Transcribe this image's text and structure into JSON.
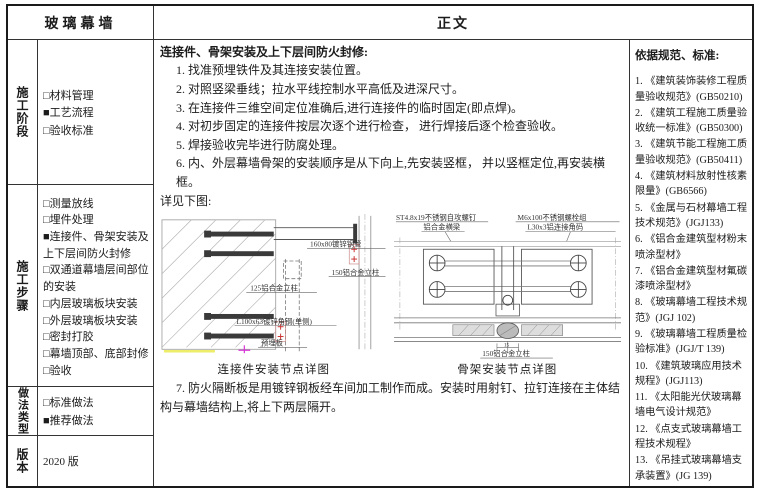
{
  "header": {
    "left_title": "玻璃幕墙",
    "right_title": "正文"
  },
  "sidebar": {
    "sections": [
      {
        "label": "施工阶段",
        "items": [
          {
            "box": "□",
            "text": "材料管理"
          },
          {
            "box": "■",
            "text": "工艺流程"
          },
          {
            "box": "□",
            "text": "验收标准"
          }
        ]
      },
      {
        "label": "施工步骤",
        "items": [
          {
            "box": "□",
            "text": "测量放线"
          },
          {
            "box": "□",
            "text": "埋件处理"
          },
          {
            "box": "■",
            "text": "连接件、骨架安装及上下层间防火封修"
          },
          {
            "box": "□",
            "text": "双通道幕墙层间部位的安装"
          },
          {
            "box": "□",
            "text": "内层玻璃板块安装"
          },
          {
            "box": "□",
            "text": "外层玻璃板块安装"
          },
          {
            "box": "□",
            "text": "密封打胶"
          },
          {
            "box": "□",
            "text": "幕墙顶部、底部封修"
          },
          {
            "box": "□",
            "text": "验收"
          }
        ]
      },
      {
        "label": "做法类型",
        "items": [
          {
            "box": "□",
            "text": "标准做法"
          },
          {
            "box": "■",
            "text": "推荐做法"
          }
        ]
      },
      {
        "label": "版本",
        "text": "2020 版"
      }
    ]
  },
  "main": {
    "title": "连接件、骨架安装及上下层间防火封修:",
    "steps": [
      "1. 找准预埋铁件及其连接安装位置。",
      "2. 对照竖梁垂线；拉水平线控制水平高低及进深尺寸。",
      "3. 在连接件三维空间定位准确后,进行连接件的临时固定(即点焊)。",
      "4. 对初步固定的连接件按层次逐个进行检查， 进行焊接后逐个检查验收。",
      "5. 焊接验收完毕进行防腐处理。",
      "6. 内、外层幕墙骨架的安装顺序是从下向上,先安装竖框， 并以竖框定位,再安装横框。"
    ],
    "see_below": "详见下图:",
    "step7": "7. 防火隔断板是用镀锌钢板经车间加工制作而成。安装时用射钉、拉钉连接在主体结构与幕墙结构上,将上下两层隔开。",
    "diagram_left": {
      "caption": "连接件安装节点详图",
      "labels": {
        "pipe": "160x80镀锌钢管",
        "col150": "150铝合金立柱",
        "col125": "125铝合金立柱",
        "angle": "L100x63镀锌角钢(单侧)",
        "plate": "预埋板"
      }
    },
    "diagram_right": {
      "caption": "骨架安装节点详图",
      "labels": {
        "screw": "ST4.8x19不锈钢自攻螺钉",
        "beam": "铝合金横梁",
        "bolt": "M6x100不锈钢螺栓组",
        "angle_code": "L30x3铝连接角码",
        "col": "150铝合金立柱",
        "dim": "15"
      }
    }
  },
  "references": {
    "title": "依据规范、标准:",
    "items": [
      "1.  《建筑装饰装修工程质量验收规范》(GB50210)",
      "2.  《建筑工程施工质量验收统一标准》(GB50300)",
      "3.  《建筑节能工程施工质量验收规范》(GB50411)",
      "4.  《建筑材料放射性核素限量》(GB6566)",
      "5.  《金属与石材幕墙工程技术规范》(JGJ133)",
      "6.  《铝合金建筑型材粉末喷涂型材》",
      "7.  《铝合金建筑型材氟碳漆喷涂型材》",
      "8.  《玻璃幕墙工程技术规范》(JGJ 102)",
      "9.  《玻璃幕墙工程质量检验标准》(JGJ/T 139)",
      "10. 《建筑玻璃应用技术规程》(JGJ113)",
      "11. 《太阳能光伏玻璃幕墙电气设计规范》",
      "12. 《点支式玻璃幕墙工程技术规程》",
      "13. 《吊挂式玻璃幕墙支承装置》(JG 139)"
    ]
  }
}
